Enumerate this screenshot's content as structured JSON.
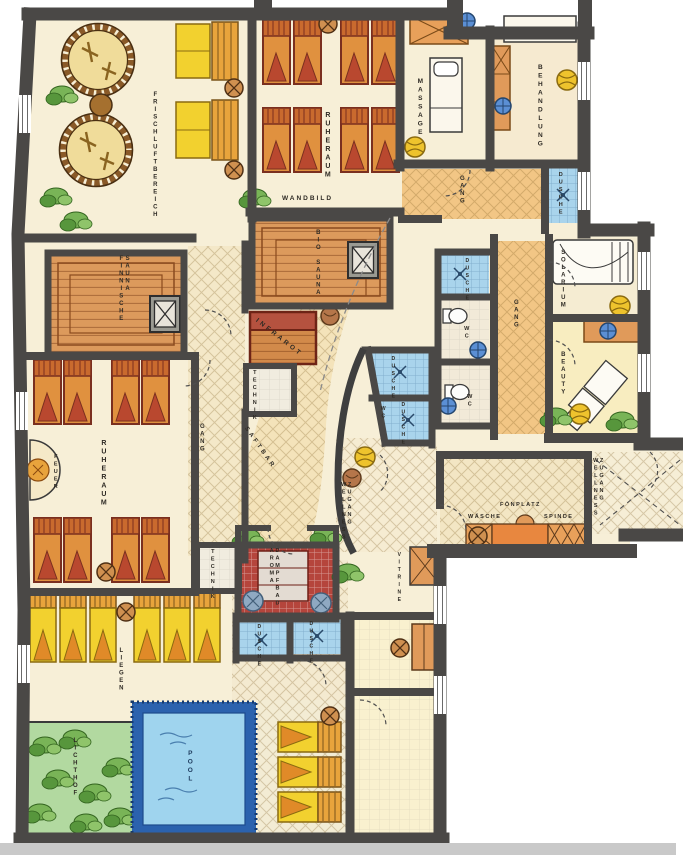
{
  "plan_type": "wellness-spa-floor-plan",
  "rooms": {
    "frischluftbereich": "FRISCHLUFTBEREICH",
    "ruheraum_top": "RUHERAUM",
    "wandbild": "WANDBILD",
    "massage": "MASSAGE",
    "gang_top": "GANG",
    "behandlung": "BEHANDLUNG",
    "dusche_top_right": "DUSCHE",
    "bio_sauna": "BIO SAUNA",
    "finnische_sauna": "FINNISCHE SAUNA",
    "infrarot": "INFRAROT",
    "technik_center": "TECHNIK",
    "dusche_center_1": "DUSCHE",
    "dusche_center_2": "DUSCHE",
    "wc_center": "WC",
    "dusche_right": "DUSCHE",
    "wc_right_1": "WC",
    "wc_right_2": "WC",
    "gang_right": "GANG",
    "solarium": "SOLARIUM",
    "beauty": "BEAUTY",
    "gang_left": "GANG",
    "ruheraum_left": "RUHERAUM",
    "feuer": "FEUER",
    "technik_left": "TECHNIK",
    "saftbar": "SAFTBAR",
    "aroma_dampfbad": "AROMA DAMPFBAD",
    "dusche_bottom_1": "DUSCHE",
    "dusche_bottom_2": "DUSCHE",
    "zugang_wellness_center": "ZUGANG WELLNESS",
    "zugang_wellness_entrance": "ZUGANG WELLNESS",
    "vitrine": "VITRINE",
    "foenplatz": "FÖNPLATZ",
    "waesche": "WÄSCHE",
    "spinde": "SPINDE",
    "liegen": "LIEGEN",
    "lichthof": "LICHTHOF",
    "pool": "POOL"
  },
  "colors": {
    "wall": "#4a4846",
    "floor": "#f7efd7",
    "corridor_orange": "#f2c685",
    "sauna_wood": "#dc9a5c",
    "steam_bath_red": "#b5453c",
    "shower_blue": "#a9d4ec",
    "pool_water": "#9fd4ee",
    "pool_edge": "#2b62ae",
    "courtyard_green": "#b2d9a0",
    "lounger_yellow": "#f2d12f",
    "lounger_orange": "#e0913f",
    "infrared_red": "#b5523f"
  }
}
